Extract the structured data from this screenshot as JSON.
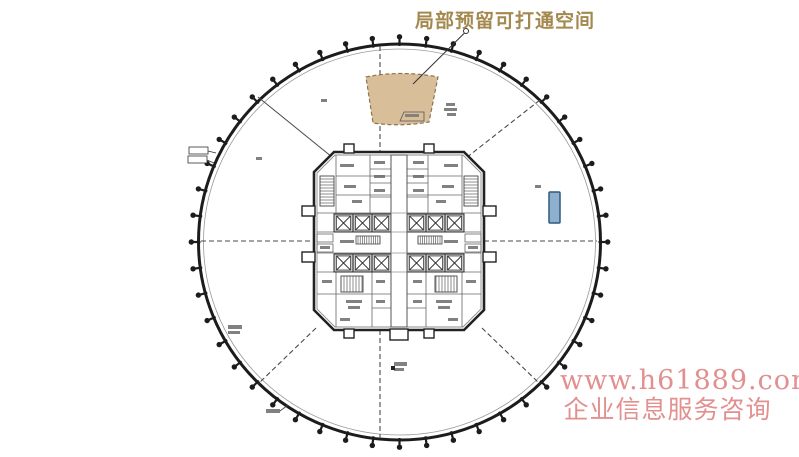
{
  "annotation": {
    "leader_label": "局部预留可打通空间"
  },
  "watermark": {
    "url": "www.h61889.com",
    "caption": "企业信息服务咨询"
  },
  "plan": {
    "perimeter_column_count": 48
  },
  "colors": {
    "annotation_gold": "#a3894f",
    "watermark_pink": "#e2908f",
    "reserved_area_fill": "#d8bf99",
    "reserved_area_border": "#8d7550",
    "blue_marker_fill": "#8fb0cc",
    "blue_marker_border": "#2f5a80",
    "line_dark": "#1c1c1c"
  }
}
